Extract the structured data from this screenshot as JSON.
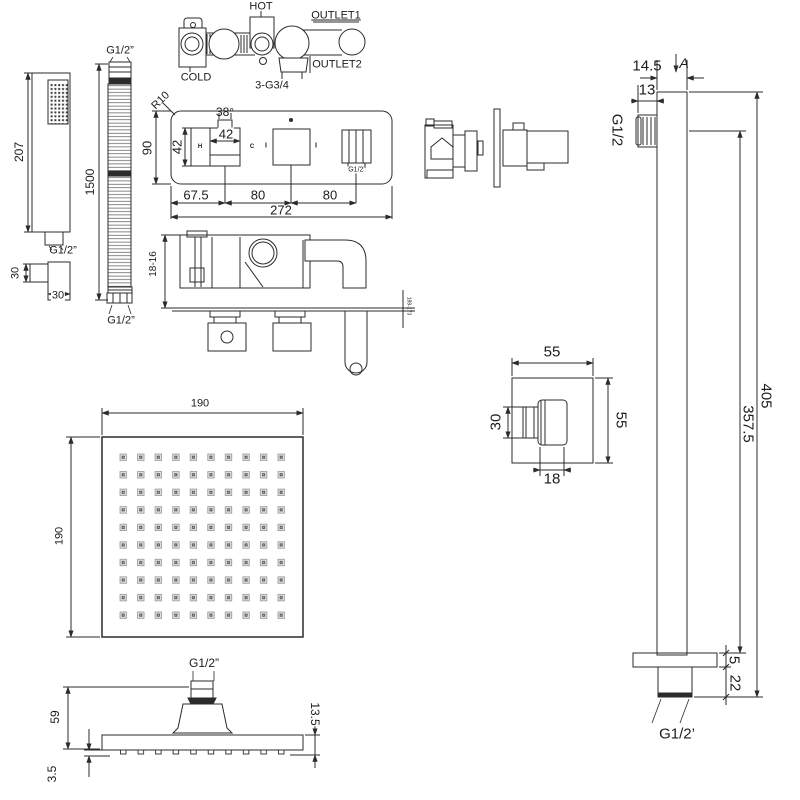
{
  "drawing_type": "shower-set-technical-dimension-drawing",
  "colors": {
    "line": "#2b2b2b",
    "background": "#ffffff",
    "nozzle_gray": "#e0e0e0",
    "nozzle_dark": "#4d4d4d"
  },
  "valve_schematic": {
    "hot": "HOT",
    "cold": "COLD",
    "outlet1": "OUTLET1",
    "outlet2": "OUTLET2",
    "connections": "3-G3/4"
  },
  "handset": {
    "length": "207",
    "thread": "G1/2”",
    "bracket_height": "30",
    "bracket_width": "30"
  },
  "hose": {
    "thread_top": "G1/2”",
    "length": "1500",
    "thread_bottom": "G1/2”"
  },
  "control_panel": {
    "corner_radius": "R10",
    "height": "90",
    "angle": "38°",
    "knob_width": "42",
    "knob_height": "42",
    "hot_mark": "H",
    "cold_mark": "C",
    "mark_left": "I",
    "mark_right": "I",
    "outlet_thread": "G1/2”",
    "dim_left": "67.5",
    "dim_mid": "80",
    "dim_right": "80",
    "total_width": "272"
  },
  "valve_body": {
    "depth_range": "18-16",
    "plate_range": "189-173"
  },
  "shower_arm": {
    "width": "14.5",
    "section_mark": "A",
    "inlet_width": "13",
    "inlet_thread": "G1/2",
    "length_overall": "405",
    "length_to_flange": "357.5",
    "flange_thickness": "5",
    "thread_length": "22",
    "outlet_thread": "G1/2’"
  },
  "wall_elbow": {
    "width": "55",
    "height": "55",
    "spout_height": "30",
    "spout_width": "18"
  },
  "head_face": {
    "width": "190",
    "height": "190"
  },
  "head_side": {
    "inlet_thread": "G1/2”",
    "height": "59",
    "edge_thickness": "13.5",
    "nozzle_height": "3.5"
  }
}
